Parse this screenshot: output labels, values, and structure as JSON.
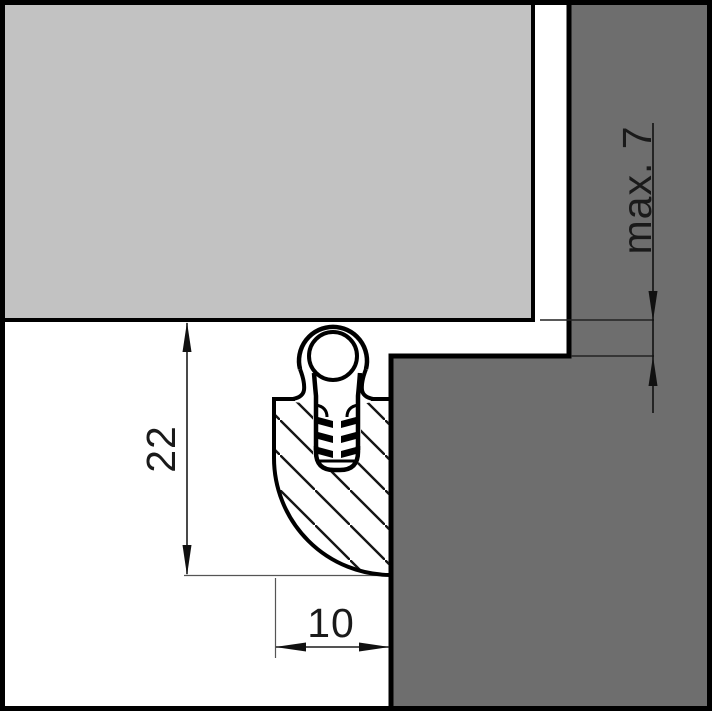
{
  "diagram": {
    "labels": {
      "seal_height": "22",
      "seal_width": "10",
      "max_gap": "max. 7"
    },
    "colors": {
      "door_panel": "#c2c2c2",
      "door_frame": "#6e6e6e",
      "outline": "#000000",
      "background": "#ffffff"
    }
  }
}
